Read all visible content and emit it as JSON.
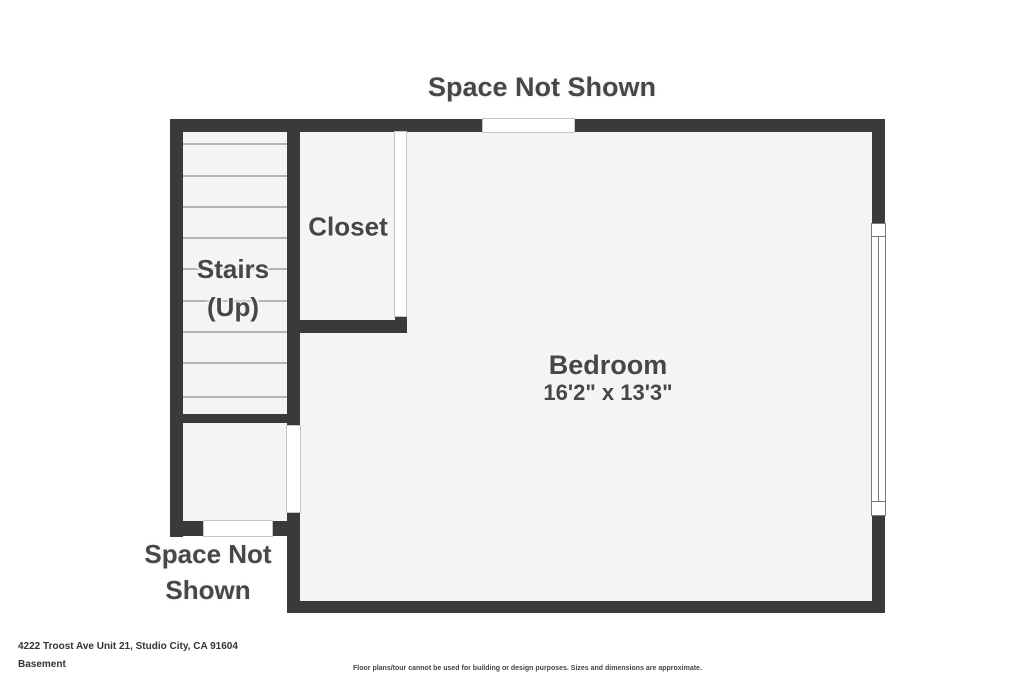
{
  "plan": {
    "top_space_label": "Space Not Shown",
    "rooms": {
      "closet": {
        "label": "Closet"
      },
      "stairs": {
        "line1": "Stairs",
        "line2": "(Up)"
      },
      "bedroom": {
        "label": "Bedroom",
        "dimensions": "16'2\" x 13'3\""
      },
      "bottom_space": {
        "line1": "Space Not",
        "line2": "Shown"
      }
    }
  },
  "footer": {
    "address": "4222 Troost Ave Unit 21, Studio City, CA 91604",
    "level": "Basement",
    "disclaimer": "Floor plans/tour cannot be used for building or design purposes. Sizes and dimensions are approximate."
  },
  "colors": {
    "wall": "#3a3a3a",
    "floor": "#f4f4f4",
    "label": "#474747",
    "tread": "#b3b3b3"
  }
}
